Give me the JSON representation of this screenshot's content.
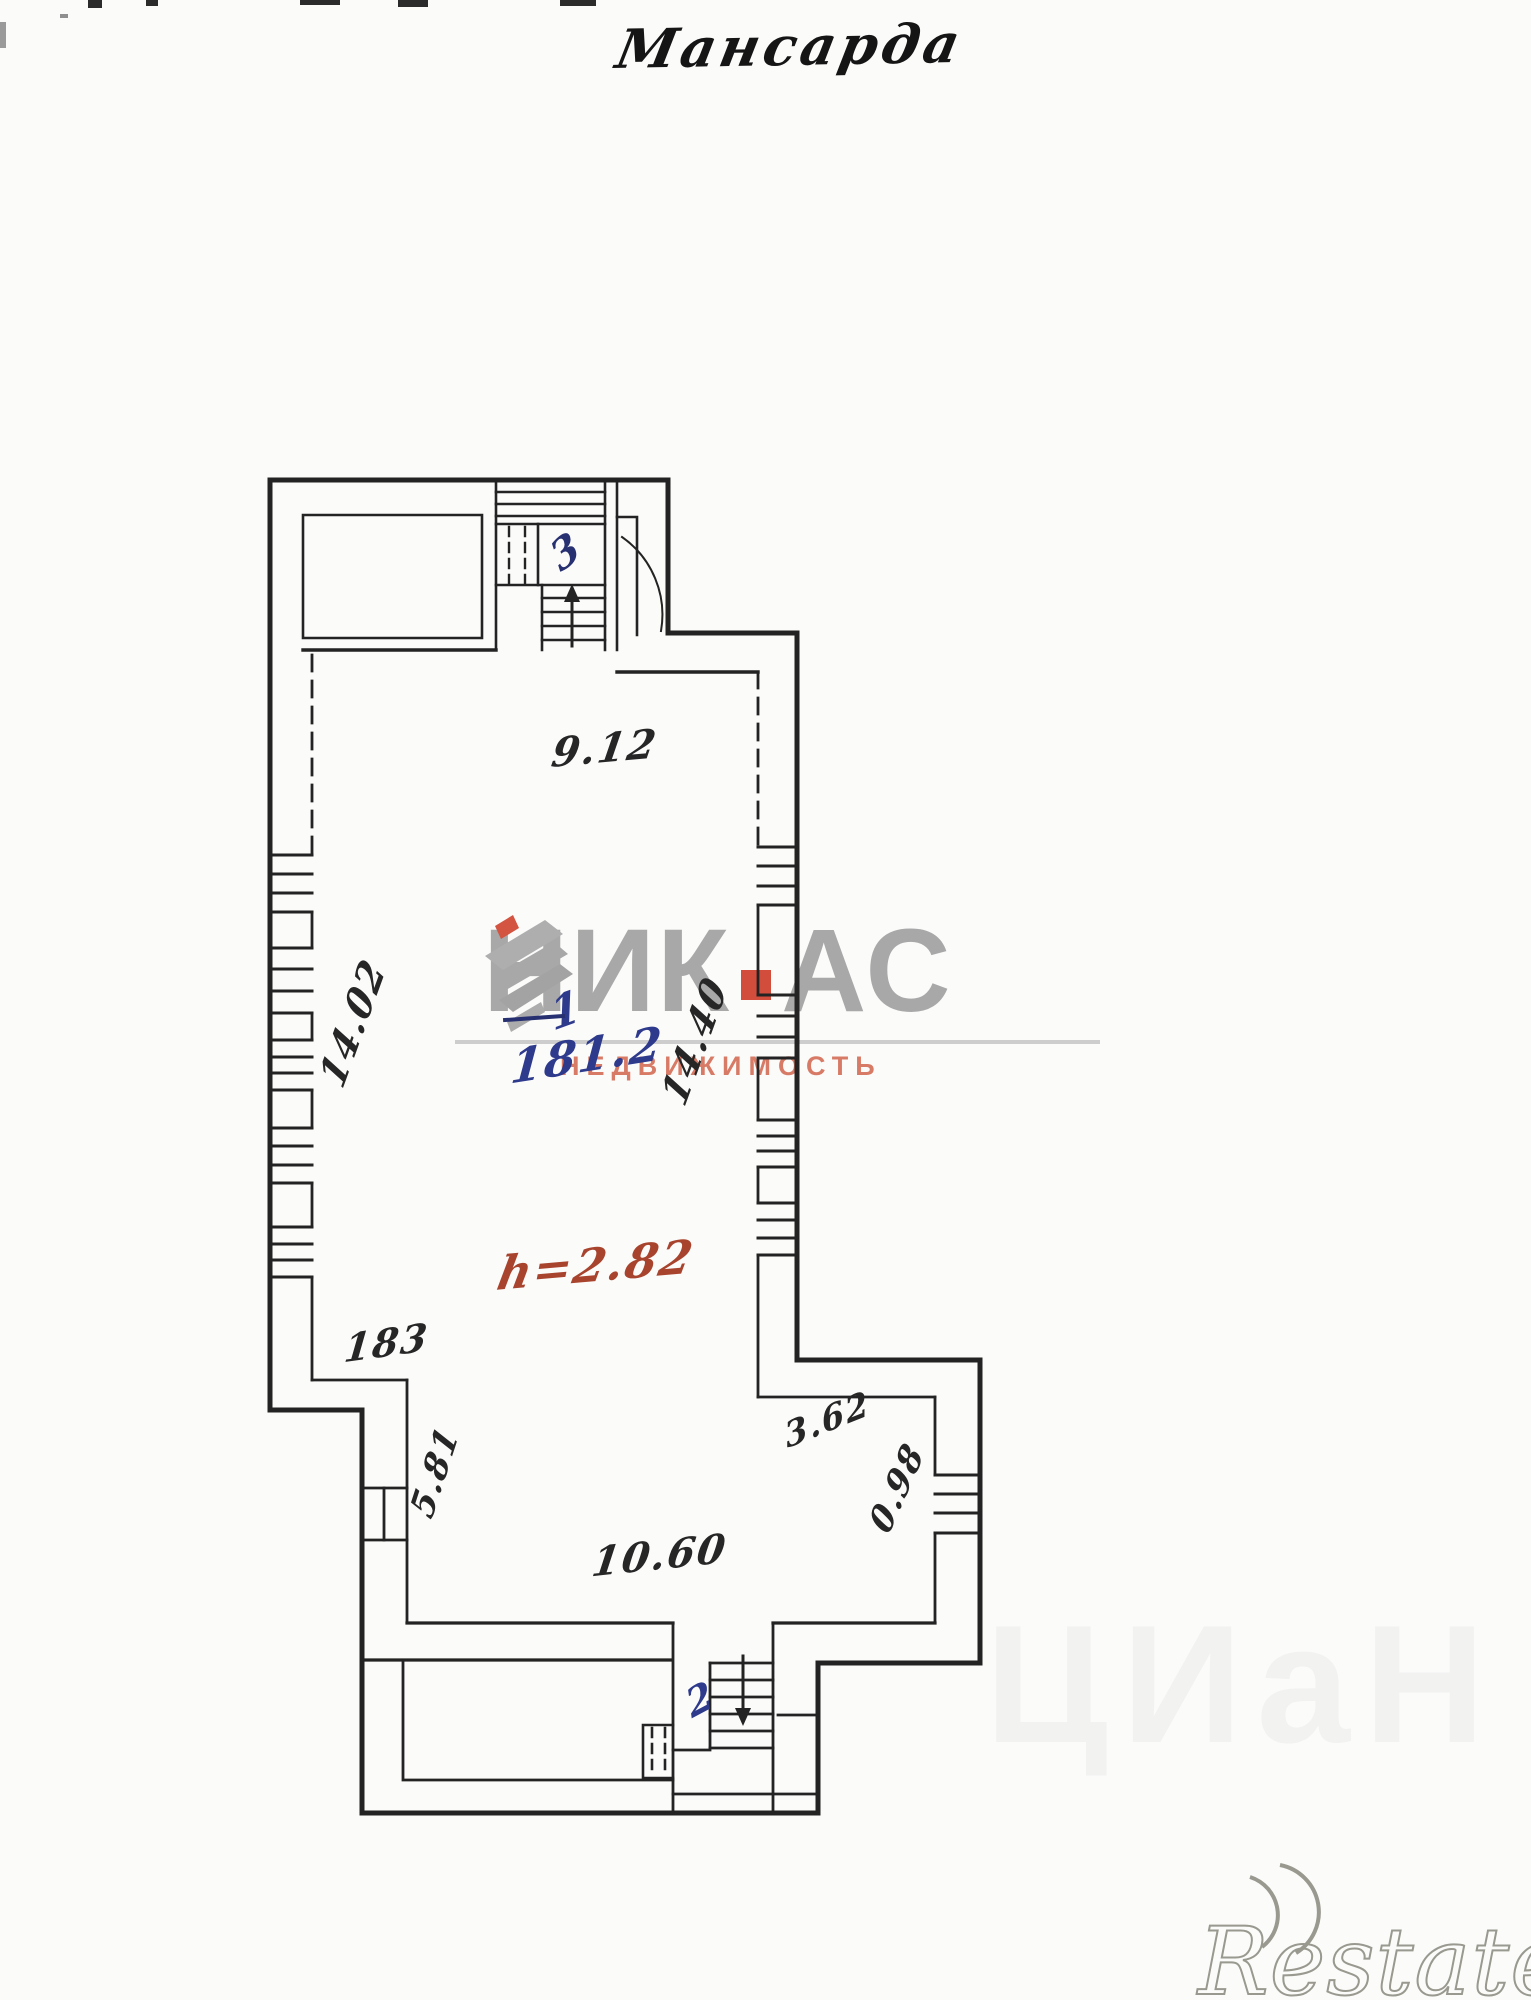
{
  "title": "Мансарда",
  "floor_plan": {
    "room_labels": [
      {
        "id": "room-3",
        "number": "3"
      },
      {
        "id": "room-1",
        "number": "1"
      },
      {
        "id": "room-2",
        "number": "2"
      }
    ],
    "area_note": {
      "room": "1",
      "value": "181.2"
    },
    "height_note": "h=2.82",
    "dimensions": [
      {
        "id": "top-width",
        "value": "9.12"
      },
      {
        "id": "left-wall",
        "value": "14.02"
      },
      {
        "id": "right-wall",
        "value": "14.40"
      },
      {
        "id": "left-step",
        "value": "183"
      },
      {
        "id": "left-door",
        "value": "5.81"
      },
      {
        "id": "right-step",
        "value": "3.62"
      },
      {
        "id": "right-window",
        "value": "0.98"
      },
      {
        "id": "bottom-width",
        "value": "10.60"
      }
    ]
  },
  "watermarks": {
    "agency": {
      "name_left": "НИК",
      "name_right": "АС",
      "subtitle": "НЕДВИЖИМОСТЬ"
    },
    "portal": "Restate",
    "faint": "ЦИаН"
  },
  "colors": {
    "ink": "#262626",
    "blue_ink": "#2e3a8c",
    "red_ink": "#a8442e",
    "logo_gray": "#a2a2a2",
    "logo_accent": "#cf3f2c",
    "logo_subtitle": "#d87b66"
  }
}
